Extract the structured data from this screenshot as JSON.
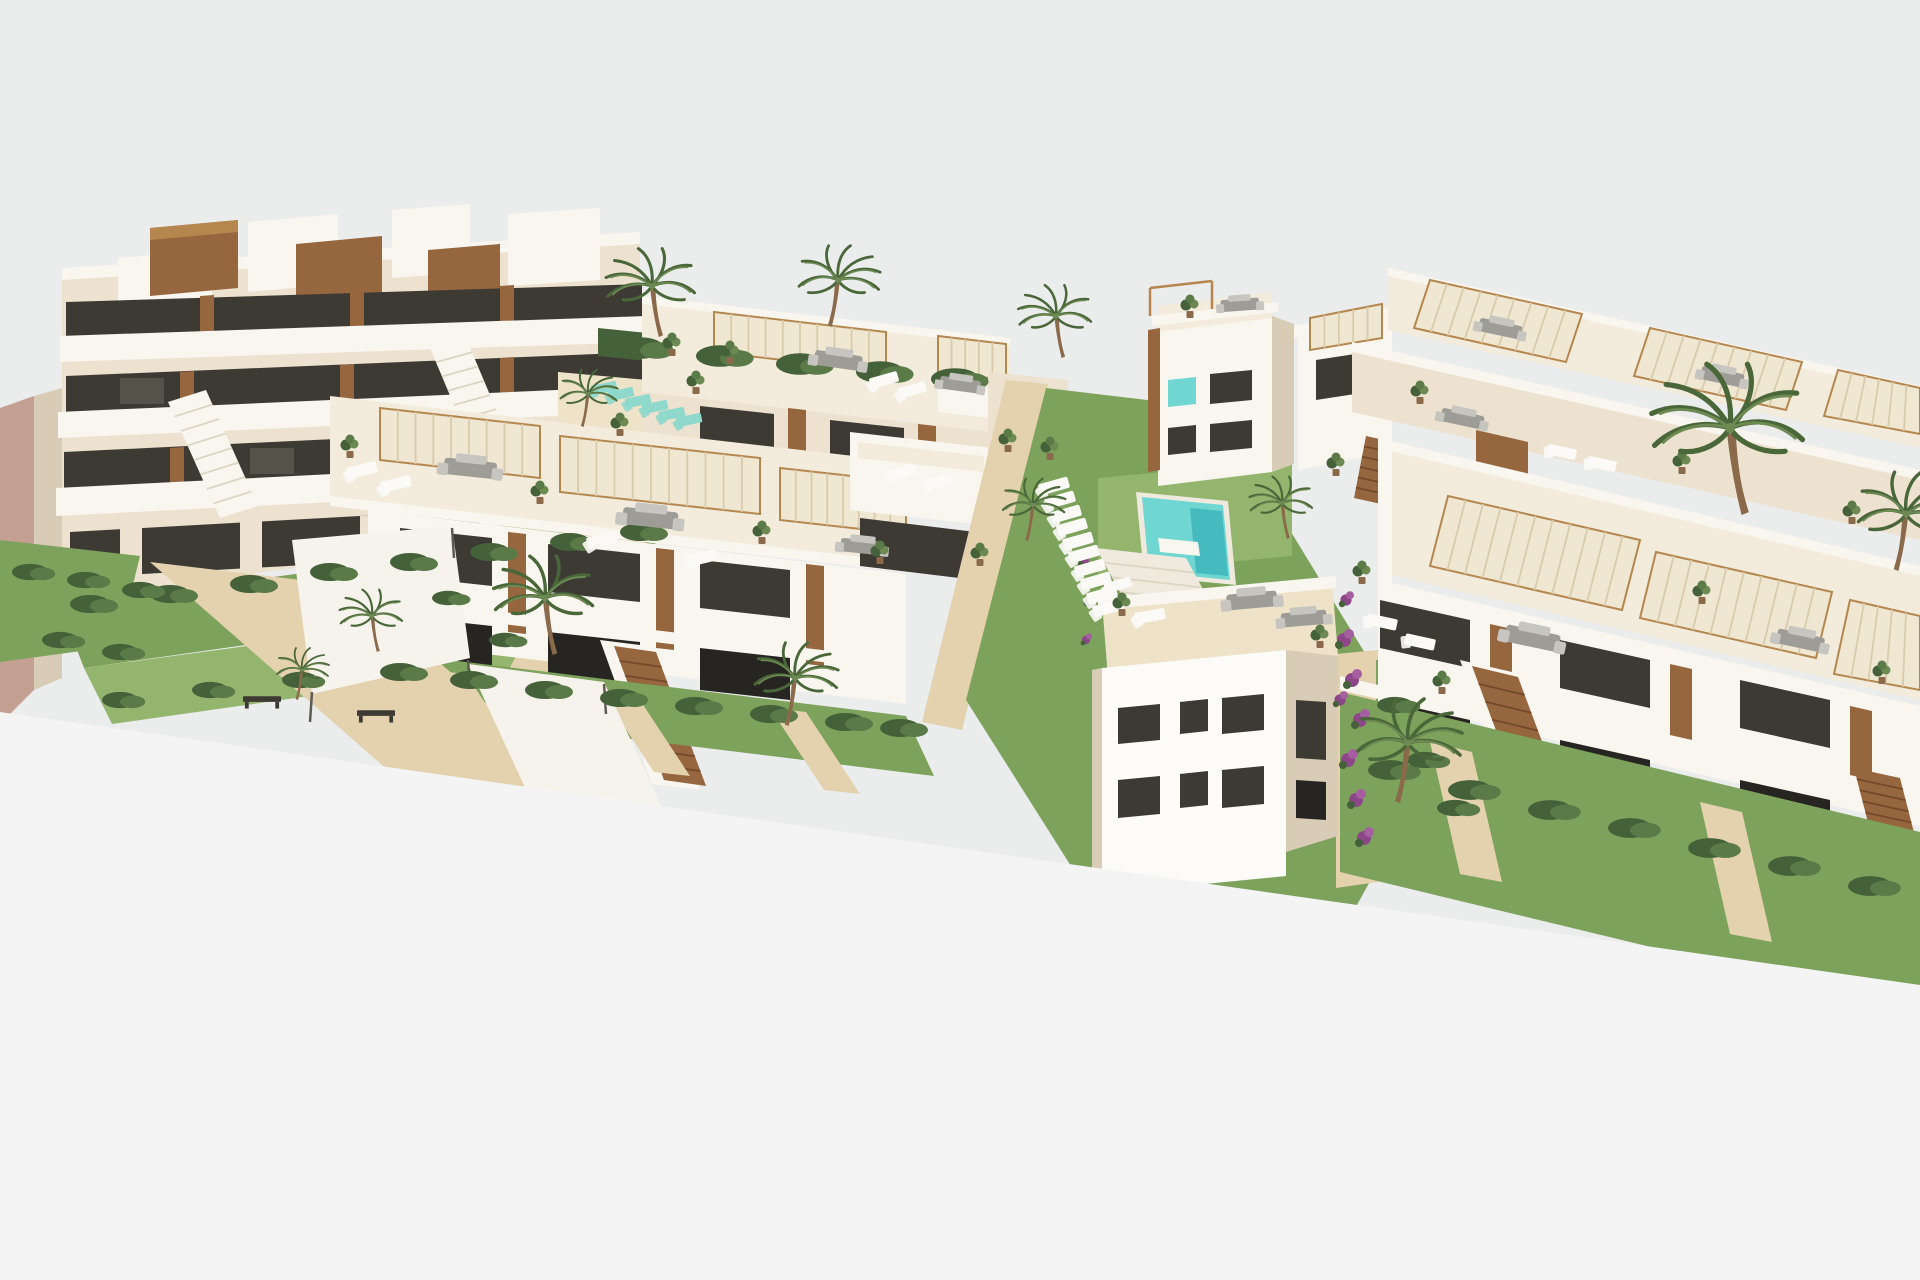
{
  "scene": {
    "type": "3d-architectural-render",
    "view": "aerial-perspective",
    "setting": "new-build Mediterranean residential complex with gardens, pools and palm trees",
    "buildings": {
      "left_block": "multi-storey apartment building with staggered white terraces, glass railings and wood accents",
      "middle_block": "two rows of two-storey townhouses with rooftop solariums and slatted pergolas",
      "right_block": "rows of two-storey townhouses with rooftop solariums, pergolas and wooden stairs",
      "corner_tower": "three-storey corner house with turquoise glazing and roof terrace",
      "foreground_house": "plain white house with dark windows and roof terrace"
    },
    "amenities": {
      "pools": 2,
      "sun_lounger_row_count": 10,
      "teal_lounger_count": 6,
      "palm_tree_count": 13,
      "shaded_walkway": true,
      "benches": 2
    }
  },
  "colors": {
    "sky": "#ebecec",
    "cut": "#f4f4f4",
    "cream": "#ece2cf",
    "creamLight": "#f3ebdb",
    "creamDark": "#ddd1bb",
    "white": "#f9f6ef",
    "shade": "#d8ccb6",
    "pink": "#c4a092",
    "wood": "#96663f",
    "woodDark": "#74492a",
    "woodLight": "#b5874f",
    "trunk": "#8a6a4a",
    "glass": "#3d3a34",
    "glassDark": "#272521",
    "glassLight": "#6e6a60",
    "grass": "#7da25c",
    "grassLight": "#93b56e",
    "hedge": "#44613a",
    "hedgeLight": "#5a7a48",
    "palm": "#6c8a52",
    "palmDark": "#4a673a",
    "sand": "#e4d2af",
    "sandLight": "#eee3c8",
    "slat": "#f0e7d3",
    "slatLine": "#d8cbab",
    "stepLine": "#dcd5c2",
    "water": "#6fd6d2",
    "waterDeep": "#2ba8b2",
    "teal": "#8fd8cc",
    "loungerWhite": "#fbfaf6",
    "furn": "#9d9c96",
    "furnLight": "#c6c5bf",
    "purple": "#8d4788",
    "purpleLight": "#a55fa0",
    "pathWhite": "#efeadd",
    "sail": "#f6f3ec",
    "postGray": "#5f5a52"
  },
  "objects": {
    "palms": [
      {
        "x": 652,
        "y": 286,
        "s": 0.85
      },
      {
        "x": 838,
        "y": 280,
        "s": 0.78,
        "m": true
      },
      {
        "x": 1056,
        "y": 316,
        "s": 0.7
      },
      {
        "x": 588,
        "y": 394,
        "s": 0.55,
        "m": true
      },
      {
        "x": 545,
        "y": 598,
        "s": 0.95
      },
      {
        "x": 795,
        "y": 678,
        "s": 0.8,
        "m": true
      },
      {
        "x": 1282,
        "y": 503,
        "s": 0.6
      },
      {
        "x": 1033,
        "y": 505,
        "s": 0.6,
        "m": true
      },
      {
        "x": 1408,
        "y": 743,
        "s": 1.0,
        "m": true
      },
      {
        "x": 1730,
        "y": 428,
        "s": 1.45
      },
      {
        "x": 1906,
        "y": 514,
        "s": 0.95,
        "m": true
      },
      {
        "x": 372,
        "y": 616,
        "s": 0.6
      },
      {
        "x": 302,
        "y": 670,
        "s": 0.5,
        "m": true
      }
    ],
    "loungers_central": [
      {
        "x": 1054,
        "y": 486,
        "r": -16,
        "s": 0.95
      },
      {
        "x": 1060,
        "y": 500,
        "r": -16,
        "s": 0.95
      },
      {
        "x": 1066,
        "y": 514,
        "r": -16,
        "s": 0.95
      },
      {
        "x": 1072,
        "y": 527,
        "r": -16,
        "s": 0.95
      },
      {
        "x": 1078,
        "y": 541,
        "r": -16,
        "s": 0.95
      },
      {
        "x": 1084,
        "y": 554,
        "r": -16,
        "s": 0.95
      },
      {
        "x": 1090,
        "y": 568,
        "r": -16,
        "s": 0.95
      },
      {
        "x": 1096,
        "y": 581,
        "r": -16,
        "s": 0.95
      },
      {
        "x": 1102,
        "y": 595,
        "r": -16,
        "s": 0.95
      },
      {
        "x": 1108,
        "y": 608,
        "r": -16,
        "s": 0.95
      }
    ],
    "loungers_roof": [
      {
        "x": 884,
        "y": 380,
        "r": -16,
        "s": 0.9
      },
      {
        "x": 912,
        "y": 390,
        "r": -16,
        "s": 0.9
      },
      {
        "x": 362,
        "y": 470,
        "r": -14,
        "s": 0.95
      },
      {
        "x": 396,
        "y": 484,
        "r": -14,
        "s": 0.95
      },
      {
        "x": 602,
        "y": 540,
        "r": -14,
        "s": 0.95
      },
      {
        "x": 702,
        "y": 558,
        "r": -14,
        "s": 0.95
      },
      {
        "x": 902,
        "y": 472,
        "r": -14,
        "s": 0.85
      },
      {
        "x": 938,
        "y": 482,
        "r": -14,
        "s": 0.85
      },
      {
        "x": 1150,
        "y": 616,
        "r": -10,
        "s": 0.95
      },
      {
        "x": 1562,
        "y": 452,
        "r": 12,
        "s": 0.9
      },
      {
        "x": 1602,
        "y": 464,
        "r": 12,
        "s": 0.9
      },
      {
        "x": 1382,
        "y": 622,
        "r": 12,
        "s": 0.95
      },
      {
        "x": 1420,
        "y": 642,
        "r": 12,
        "s": 0.95
      },
      {
        "x": 1118,
        "y": 585,
        "r": -16,
        "s": 0.85
      }
    ],
    "loungers_teal": [
      {
        "x": 604,
        "y": 388,
        "r": -12,
        "s": 0.8
      },
      {
        "x": 621,
        "y": 394,
        "r": -12,
        "s": 0.8
      },
      {
        "x": 638,
        "y": 401,
        "r": -12,
        "s": 0.8
      },
      {
        "x": 655,
        "y": 407,
        "r": -12,
        "s": 0.8
      },
      {
        "x": 672,
        "y": 414,
        "r": -12,
        "s": 0.8
      },
      {
        "x": 689,
        "y": 420,
        "r": -12,
        "s": 0.8
      }
    ],
    "sofas": [
      {
        "x": 838,
        "y": 362,
        "s": 1,
        "r": 8
      },
      {
        "x": 960,
        "y": 386,
        "s": 0.85,
        "r": 8
      },
      {
        "x": 470,
        "y": 470,
        "s": 1.1,
        "r": 6
      },
      {
        "x": 650,
        "y": 520,
        "s": 1.15,
        "r": 6
      },
      {
        "x": 862,
        "y": 548,
        "s": 0.9,
        "r": 6
      },
      {
        "x": 1240,
        "y": 306,
        "s": 0.8,
        "r": -4
      },
      {
        "x": 1252,
        "y": 602,
        "s": 1.05,
        "r": -5
      },
      {
        "x": 1304,
        "y": 620,
        "s": 0.95,
        "r": -5
      },
      {
        "x": 1500,
        "y": 330,
        "s": 0.9,
        "r": 12
      },
      {
        "x": 1722,
        "y": 378,
        "s": 0.9,
        "r": 12
      },
      {
        "x": 1462,
        "y": 420,
        "s": 0.9,
        "r": 12
      },
      {
        "x": 1532,
        "y": 640,
        "s": 1.15,
        "r": 12
      },
      {
        "x": 1800,
        "y": 642,
        "s": 1.0,
        "r": 12
      }
    ],
    "plants": [
      {
        "x": 350,
        "y": 452
      },
      {
        "x": 540,
        "y": 498
      },
      {
        "x": 762,
        "y": 538
      },
      {
        "x": 880,
        "y": 558
      },
      {
        "x": 696,
        "y": 388
      },
      {
        "x": 1122,
        "y": 610
      },
      {
        "x": 1320,
        "y": 642
      },
      {
        "x": 1190,
        "y": 312
      },
      {
        "x": 1420,
        "y": 398
      },
      {
        "x": 1682,
        "y": 468
      },
      {
        "x": 1852,
        "y": 518
      },
      {
        "x": 1362,
        "y": 578
      },
      {
        "x": 1702,
        "y": 598
      },
      {
        "x": 1882,
        "y": 678
      },
      {
        "x": 1442,
        "y": 688
      },
      {
        "x": 672,
        "y": 350
      },
      {
        "x": 730,
        "y": 358
      },
      {
        "x": 1008,
        "y": 446
      },
      {
        "x": 1050,
        "y": 454
      },
      {
        "x": 1336,
        "y": 470
      },
      {
        "x": 620,
        "y": 430
      },
      {
        "x": 980,
        "y": 560
      }
    ],
    "benches": [
      {
        "x": 262,
        "y": 700,
        "s": 0.95
      },
      {
        "x": 376,
        "y": 714,
        "s": 0.95
      }
    ],
    "hedges": [
      {
        "x": 90,
        "y": 604
      },
      {
        "x": 170,
        "y": 594
      },
      {
        "x": 250,
        "y": 584
      },
      {
        "x": 330,
        "y": 572
      },
      {
        "x": 410,
        "y": 562
      },
      {
        "x": 490,
        "y": 552
      },
      {
        "x": 570,
        "y": 542
      },
      {
        "x": 640,
        "y": 532
      },
      {
        "x": 120,
        "y": 700,
        "s": 0.9
      },
      {
        "x": 210,
        "y": 690,
        "s": 0.9
      },
      {
        "x": 300,
        "y": 680,
        "s": 0.9
      },
      {
        "x": 400,
        "y": 672
      },
      {
        "x": 470,
        "y": 680
      },
      {
        "x": 545,
        "y": 690
      },
      {
        "x": 620,
        "y": 698
      },
      {
        "x": 695,
        "y": 706
      },
      {
        "x": 770,
        "y": 714
      },
      {
        "x": 845,
        "y": 722
      },
      {
        "x": 900,
        "y": 728
      },
      {
        "x": 1390,
        "y": 770,
        "s": 1.1
      },
      {
        "x": 1470,
        "y": 790,
        "s": 1.1
      },
      {
        "x": 1550,
        "y": 810,
        "s": 1.1
      },
      {
        "x": 1630,
        "y": 828,
        "s": 1.1
      },
      {
        "x": 1710,
        "y": 848,
        "s": 1.1
      },
      {
        "x": 1790,
        "y": 866,
        "s": 1.1
      },
      {
        "x": 1870,
        "y": 886,
        "s": 1.1
      },
      {
        "x": 1395,
        "y": 705,
        "s": 0.9
      },
      {
        "x": 1425,
        "y": 760,
        "s": 0.9
      },
      {
        "x": 1455,
        "y": 808,
        "s": 0.9
      },
      {
        "x": 30,
        "y": 572,
        "s": 0.9
      },
      {
        "x": 85,
        "y": 580,
        "s": 0.9
      },
      {
        "x": 140,
        "y": 590,
        "s": 0.9
      },
      {
        "x": 60,
        "y": 640,
        "s": 0.9
      },
      {
        "x": 120,
        "y": 652,
        "s": 0.9
      },
      {
        "x": 640,
        "y": 348,
        "s": 1.2
      },
      {
        "x": 720,
        "y": 356,
        "s": 1.2
      },
      {
        "x": 800,
        "y": 364,
        "s": 1.2
      },
      {
        "x": 880,
        "y": 372,
        "s": 1.2
      },
      {
        "x": 955,
        "y": 379,
        "s": 1.2
      },
      {
        "x": 448,
        "y": 598,
        "s": 0.8
      },
      {
        "x": 505,
        "y": 640,
        "s": 0.8
      }
    ],
    "bougainvillea": [
      {
        "x": 1344,
        "y": 640
      },
      {
        "x": 1352,
        "y": 680
      },
      {
        "x": 1360,
        "y": 720
      },
      {
        "x": 1348,
        "y": 760
      },
      {
        "x": 1356,
        "y": 800
      },
      {
        "x": 1364,
        "y": 838
      },
      {
        "x": 1340,
        "y": 700,
        "s": 0.8
      },
      {
        "x": 1346,
        "y": 600,
        "s": 0.8
      },
      {
        "x": 1084,
        "y": 560,
        "s": 0.7
      },
      {
        "x": 1090,
        "y": 600,
        "s": 0.7
      },
      {
        "x": 1086,
        "y": 640,
        "s": 0.6
      }
    ]
  }
}
